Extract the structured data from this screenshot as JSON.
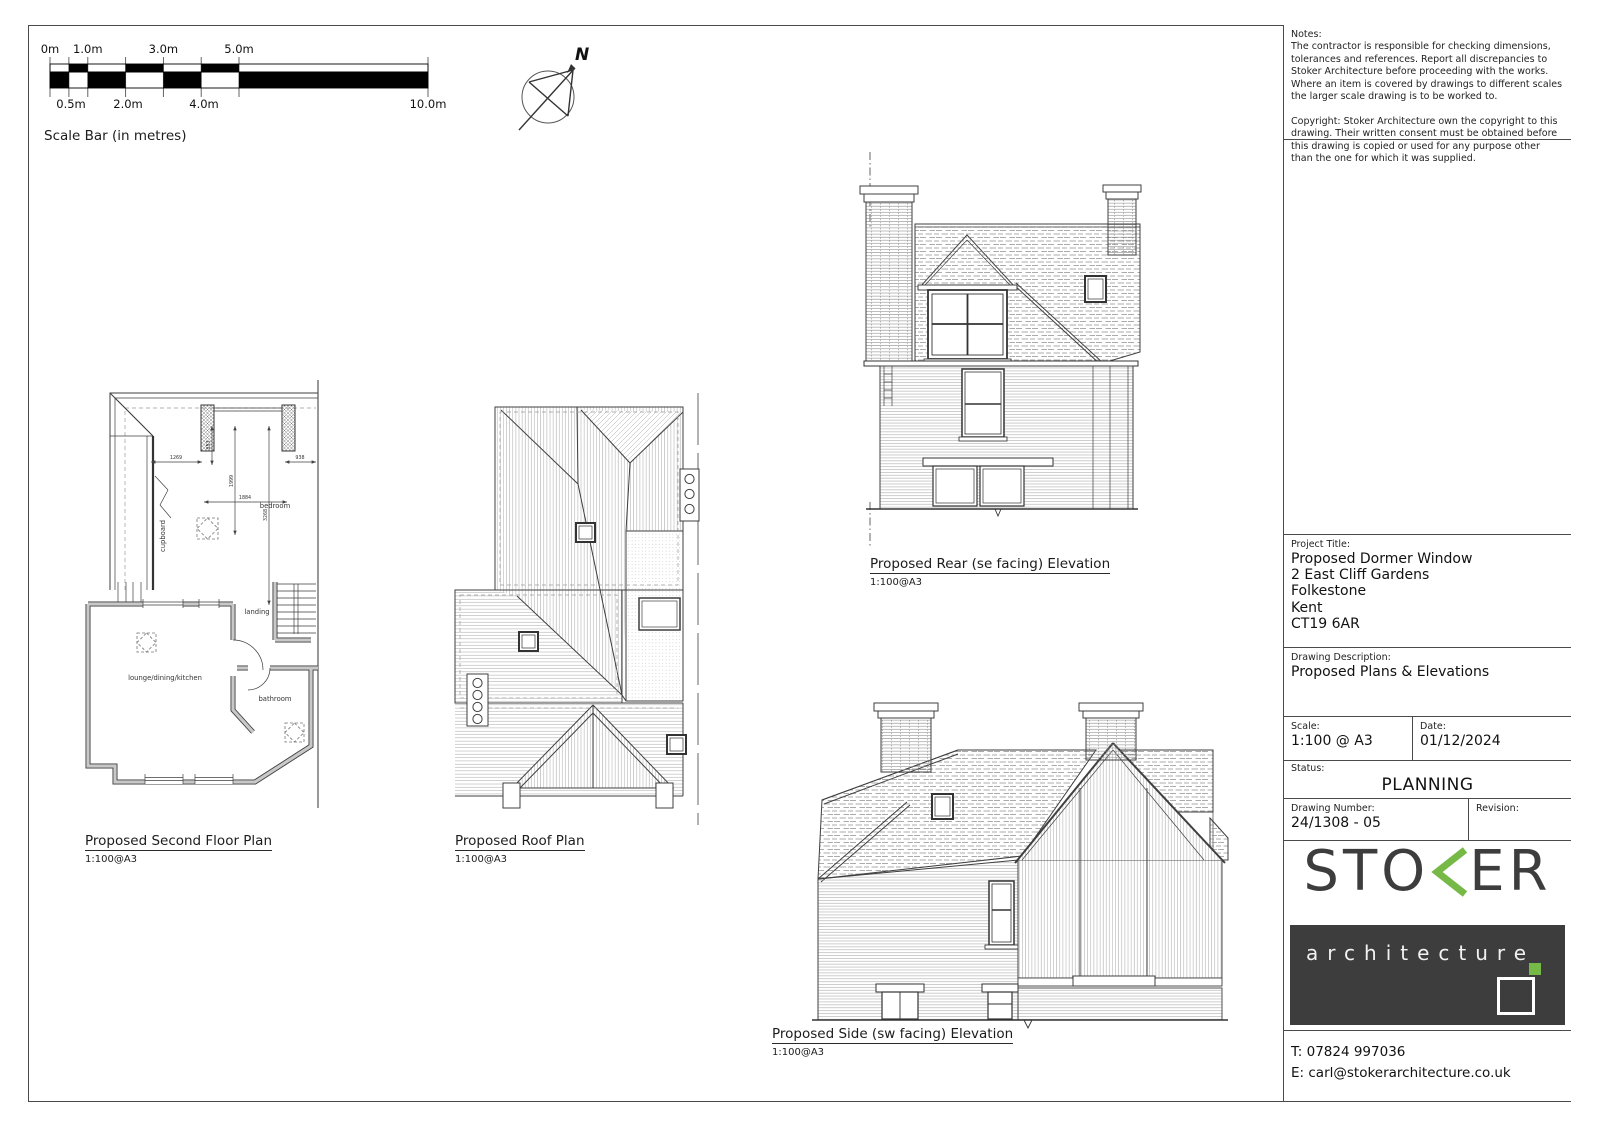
{
  "colors": {
    "accent_green": "#76b947",
    "ink": "#3d3d3d"
  },
  "scale_bar": {
    "title": "Scale Bar (in metres)",
    "top_labels": [
      "0m",
      "1.0m",
      "3.0m",
      "5.0m"
    ],
    "bottom_labels": [
      "0.5m",
      "2.0m",
      "4.0m",
      "10.0m"
    ]
  },
  "north_label": "N",
  "drawings": {
    "floor_plan": {
      "title": "Proposed Second Floor Plan",
      "scale": "1:100@A3",
      "rooms": {
        "cupboard": "cupboard",
        "bedroom": "bedroom",
        "landing": "landing",
        "lounge": "lounge/dining/kitchen",
        "bathroom": "bathroom"
      },
      "dims": {
        "d1269": "1269",
        "d853": "853",
        "d1999": "1999",
        "d3268": "3268",
        "d938": "938",
        "d1884": "1884"
      }
    },
    "roof_plan": {
      "title": "Proposed Roof Plan",
      "scale": "1:100@A3"
    },
    "rear_elevation": {
      "title": "Proposed Rear (se facing) Elevation",
      "scale": "1:100@A3"
    },
    "side_elevation": {
      "title": "Proposed Side (sw facing) Elevation",
      "scale": "1:100@A3"
    }
  },
  "title_block": {
    "notes": {
      "label": "Notes:",
      "p1": "The contractor is responsible for checking dimensions, tolerances and references.  Report all discrepancies to Stoker Architecture before proceeding with the works.",
      "p2": "Where an item is covered by drawings to different scales the larger scale drawing is to be worked to.",
      "p3": "Copyright: Stoker Architecture own the copyright to this drawing. Their written consent must be obtained before this drawing is copied or used for any purpose other than the one for which it was supplied."
    },
    "project": {
      "label": "Project Title:",
      "lines": [
        "Proposed Dormer Window",
        "2 East Cliff Gardens",
        "Folkestone",
        "Kent",
        "CT19 6AR"
      ]
    },
    "description": {
      "label": "Drawing Description:",
      "value": "Proposed Plans & Elevations"
    },
    "scale": {
      "label": "Scale:",
      "value": "1:100 @ A3"
    },
    "date": {
      "label": "Date:",
      "value": "01/12/2024"
    },
    "status": {
      "label": "Status:",
      "value": "PLANNING"
    },
    "drawing_number": {
      "label": "Drawing Number:",
      "value": "24/1308 - 05"
    },
    "revision": {
      "label": "Revision:",
      "value": ""
    },
    "logo": {
      "word_left": "STO",
      "word_right": "ER",
      "sub": "architecture"
    },
    "contact": {
      "phone": "T: 07824 997036",
      "email": "E: carl@stokerarchitecture.co.uk"
    }
  }
}
